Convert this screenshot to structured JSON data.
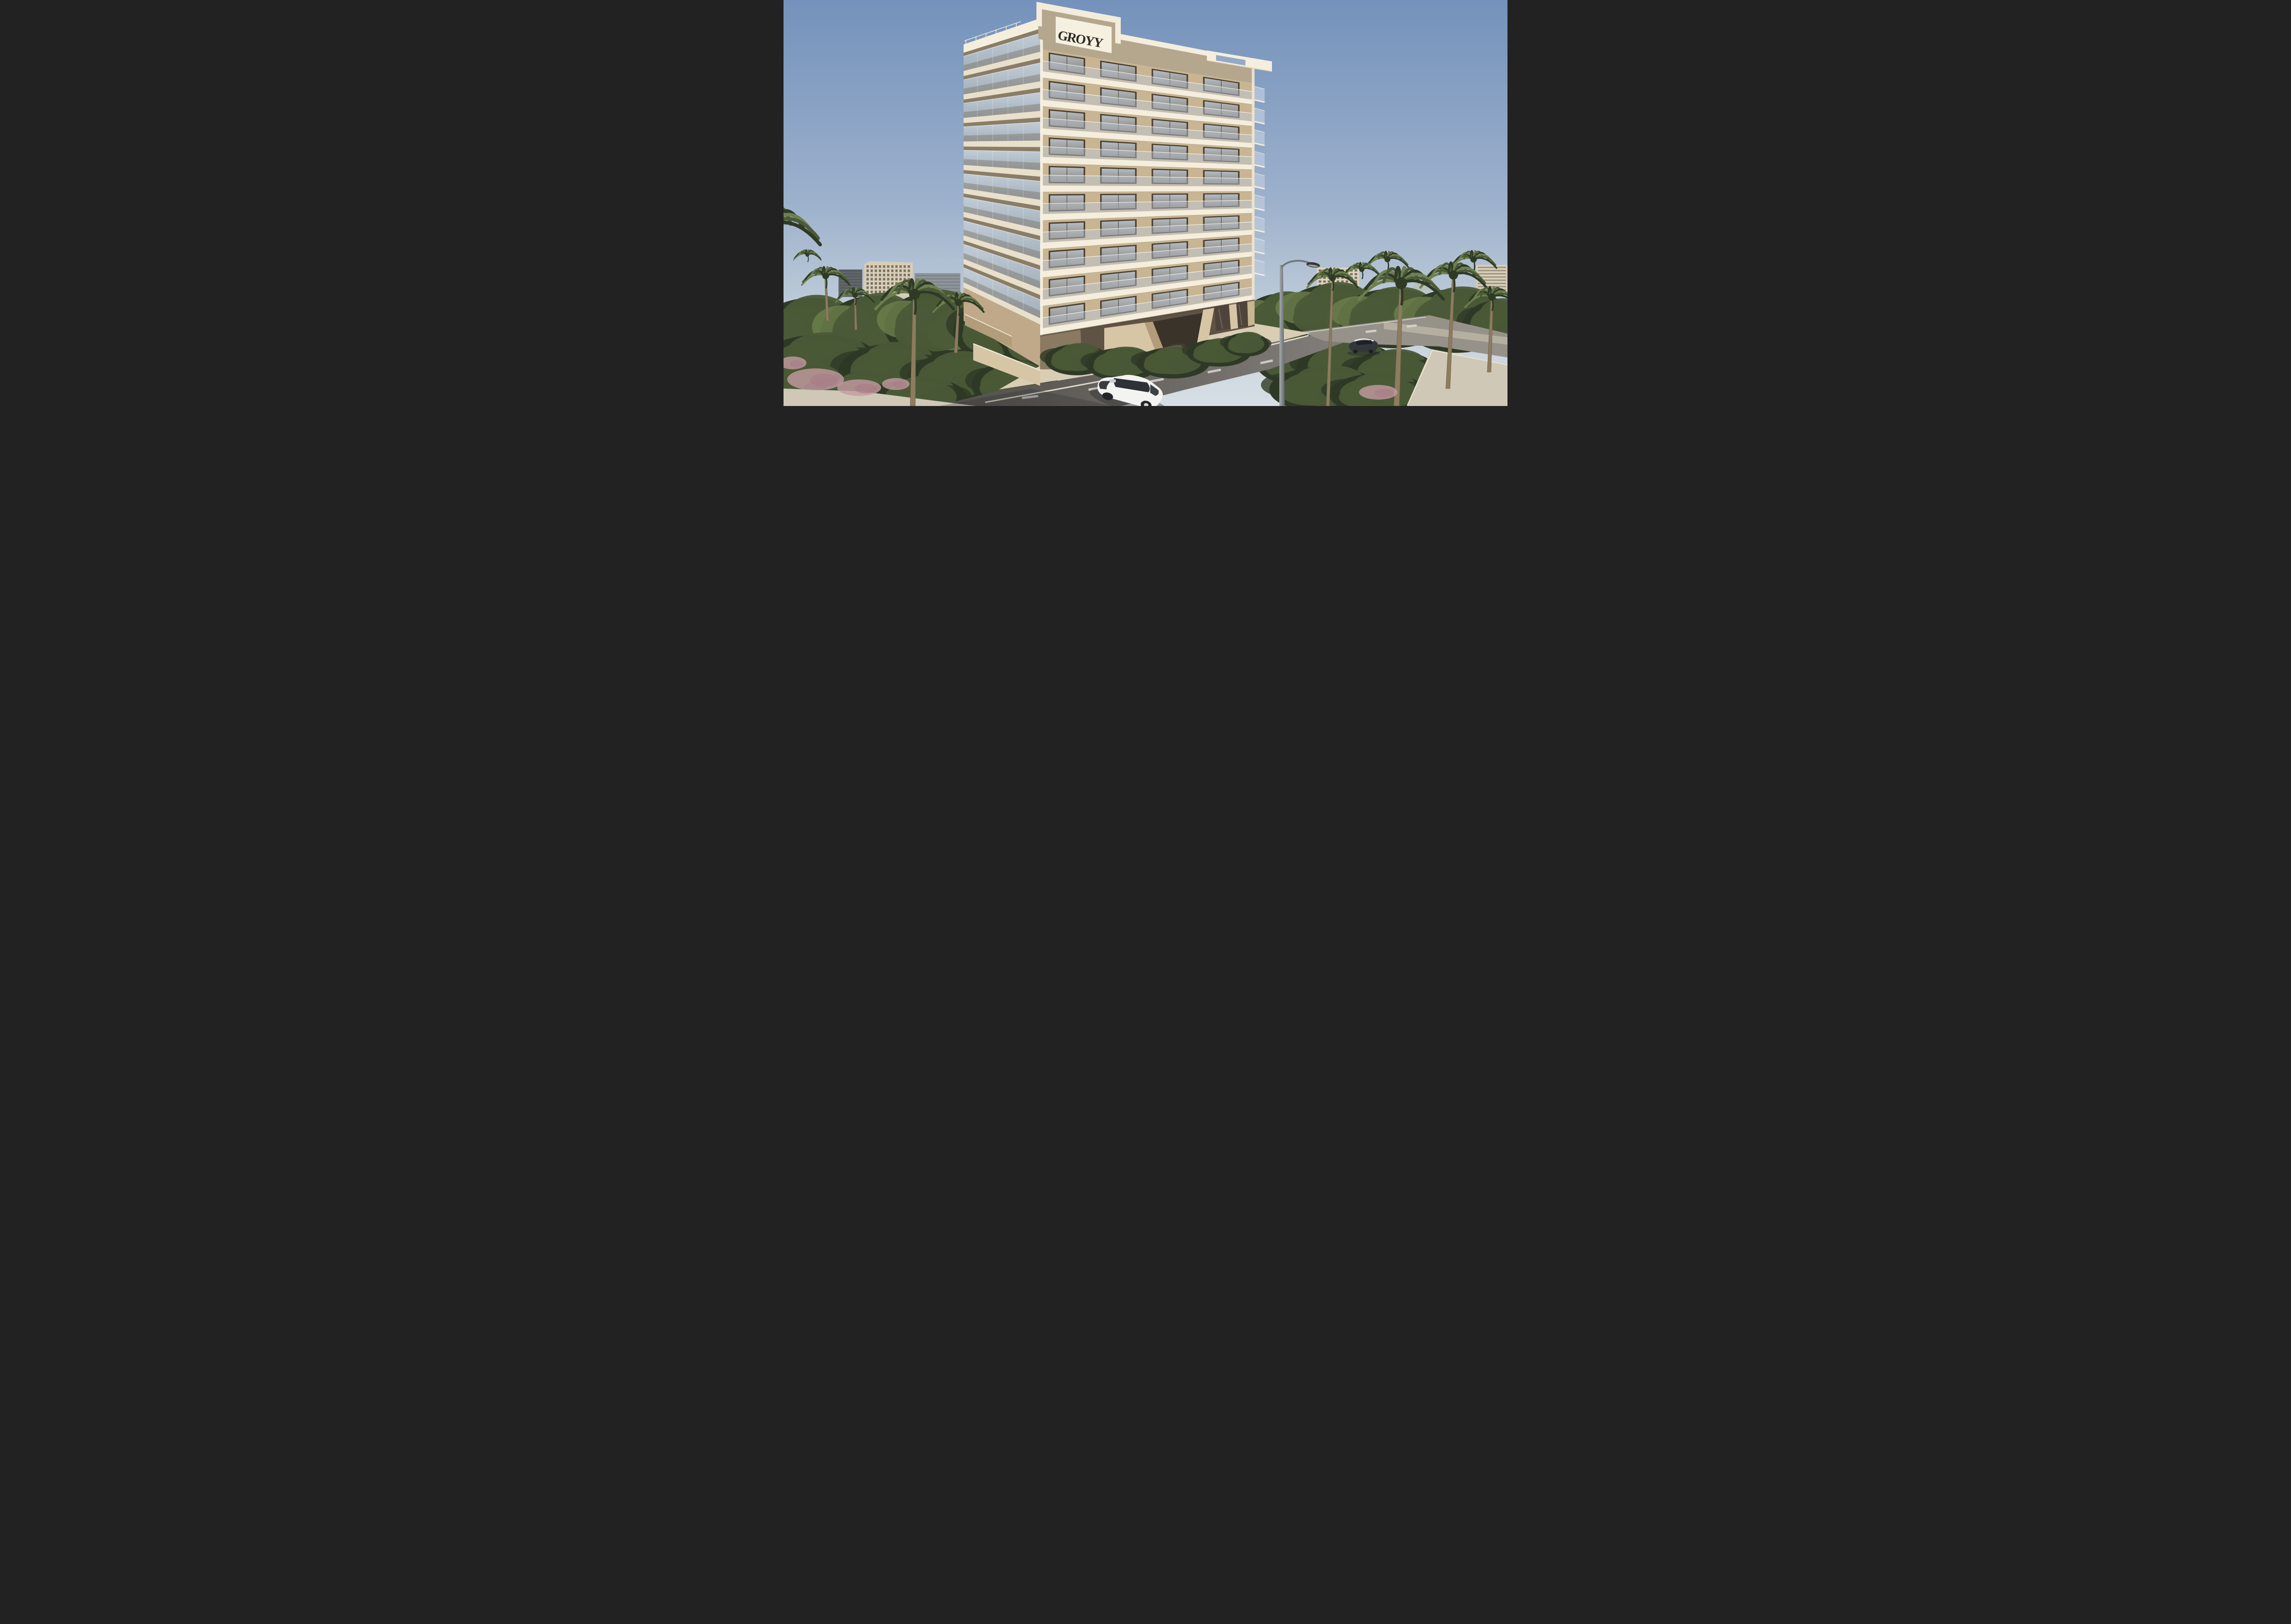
{
  "scene": {
    "type": "architectural-exterior-render",
    "time_of_day": "clear daylight",
    "description": "Beige residential tower with balconies, palm trees, street with cars and lamp"
  },
  "building": {
    "sign_text": "GROYY",
    "floors": 10,
    "window_bays": 4,
    "right_balconies": 9
  },
  "palette": {
    "sky_top": "#7492bb",
    "sky_mid": "#9db1cc",
    "sky_horizon": "#c6d2dc",
    "sky_low": "#d6dfe4",
    "slab_sun": "#f5eedd",
    "slab_side": "#e9e0cc",
    "slab_under": "#b3a68c",
    "wall": "#c9b592",
    "wall_dark": "#b19b76",
    "parapet": "#b4a78e",
    "sign_bg": "#f6f0e1",
    "sign_ink": "#2e2a23",
    "frame_white": "#f3ecdb",
    "glass_sky": "#bccadb",
    "glass_shadow": "#7e7365",
    "win_frame": "#4a3e30",
    "win_glass_hi": "#aab4bc",
    "win_glass_lo": "#7e7466",
    "pod_shadow": "#5f5345",
    "pillar": "#d7c6a6",
    "pillar_dark": "#b29c79",
    "stone": "#b7a88e",
    "drive": "#d9cdb4",
    "road_dark": "#57544f",
    "road_light": "#827e79",
    "side_road": "#969289",
    "sidewalk": "#cfc8b6",
    "curb": "#ece6d6",
    "lane": "#d9d7d1",
    "wall_concrete": "#b8b2a4",
    "green_dark": "#2e3a26",
    "green_mid": "#4a5a37",
    "green_lite": "#6d7f4c",
    "pink": "#c59ba3",
    "pink_dark": "#a87f88",
    "trunk": "#8d7c5f",
    "trunk_dark": "#6f6049",
    "bgb_beige": "#d8cdb6",
    "bgb_gray": "#61676b",
    "bgb_gray2": "#8f9598",
    "bgb_win": "#6f675a",
    "bgb_cream": "#ddd3be",
    "lamp": "#8f959a",
    "lamp_dark": "#34383b",
    "car_white": "#f3f3f1",
    "car_glass": "#2e3236",
    "car_bronze": "#4a3c30",
    "car_bronze_hi": "#8a7a69",
    "car_dark": "#33373b",
    "car_roof": "#e7e9e9"
  }
}
